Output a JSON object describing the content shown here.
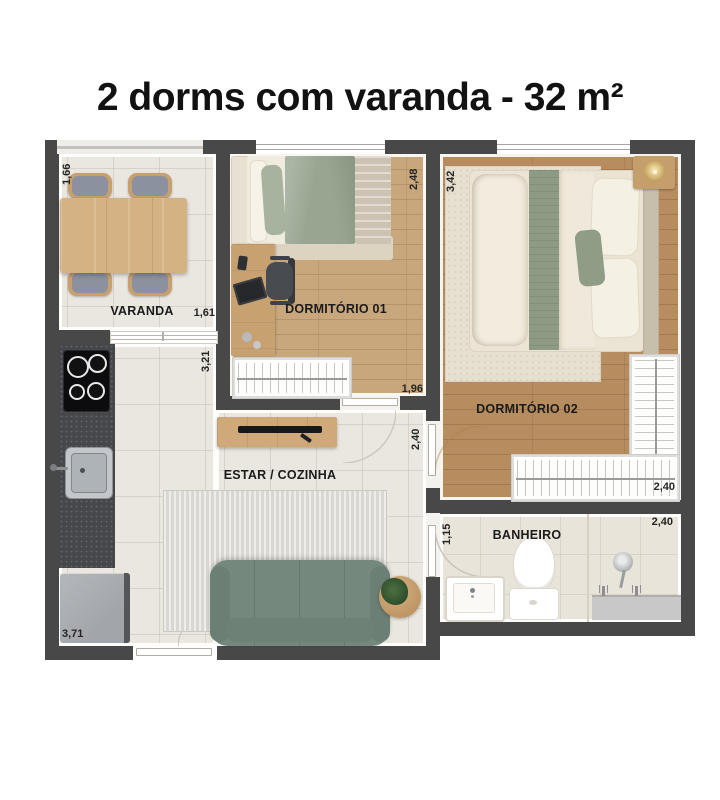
{
  "title": "2 dorms com varanda - 32 m²",
  "rooms": {
    "varanda": "VARANDA",
    "dormitorio1": "DORMITÓRIO 01",
    "dormitorio2": "DORMITÓRIO 02",
    "estar_cozinha": "ESTAR / COZINHA",
    "banheiro": "BANHEIRO"
  },
  "dimensions": {
    "varanda_depth": "1,66",
    "varanda_door": "1,61",
    "kitchen_wall": "3,21",
    "dorm1_depth": "2,48",
    "dorm1_width": "1,96",
    "dorm2_depth": "3,42",
    "dorm2_width": "2,40",
    "living_opening": "2,40",
    "banheiro_depth": "1,15",
    "banheiro_width": "2,40",
    "kitchen_length": "3,71"
  },
  "colors": {
    "wall": "#484848",
    "tile_floor": "#eae7e0",
    "wood_light": "#c9a77d",
    "wood_medium": "#b78d60",
    "sofa_green": "#75887e",
    "sage_accent": "#93a08a",
    "text": "#121212"
  }
}
